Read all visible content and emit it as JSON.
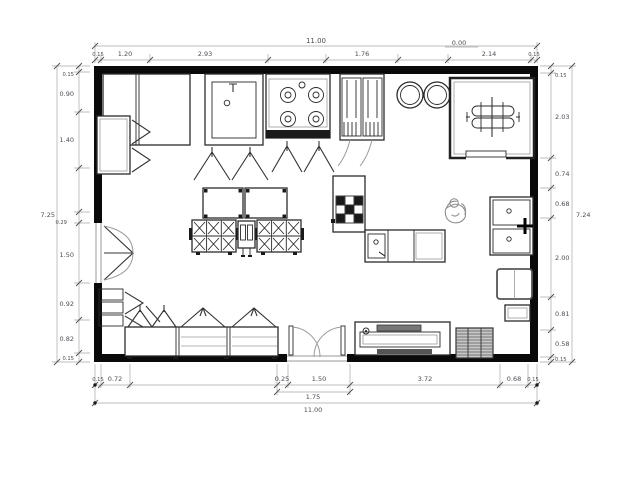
{
  "drawing": {
    "kind": "kitchen-floor-plan",
    "dimensions": {
      "top": {
        "overall": "11.00",
        "zero_marker": "0.00",
        "segments": [
          "0.15",
          "1.20",
          "2.93",
          "1.76",
          "2.14",
          "0.15"
        ]
      },
      "bottom": {
        "overall": "11.00",
        "subtotal": "1.75",
        "segments": [
          "0.15",
          "0.72",
          "0.25",
          "1.50",
          "3.72",
          "0.68",
          "0.15"
        ]
      },
      "left": {
        "overall": "7.25",
        "segments": [
          "0.15",
          "0.90",
          "1.40",
          "0.29",
          "1.50",
          "0.92",
          "0.82",
          "0.15"
        ]
      },
      "right": {
        "overall": "7.24",
        "segments": [
          "0.15",
          "2.03",
          "0.74",
          "0.68",
          "2.00",
          "0.81",
          "0.58",
          "0.15"
        ]
      }
    },
    "fixtures": [
      "sink-unit",
      "four-burner-range",
      "door-cabinet",
      "stock-kettles",
      "walk-in-cold-room",
      "shelf-rack",
      "prep-tables",
      "burner-banks",
      "island-center-unit",
      "l-shaped-counter",
      "grid-appliance",
      "prep-sink",
      "double-bowl-sink",
      "base-cabinet",
      "wall-shelves",
      "bottom-shelving",
      "double-swing-door",
      "side-swing-door",
      "work-table",
      "floor-grate",
      "person-figure"
    ],
    "colors": {
      "wall": "#0a0a0a",
      "linework": "#2b2b2b",
      "dim_line": "#a8a8a8",
      "dim_text": "#4c4c55"
    }
  }
}
